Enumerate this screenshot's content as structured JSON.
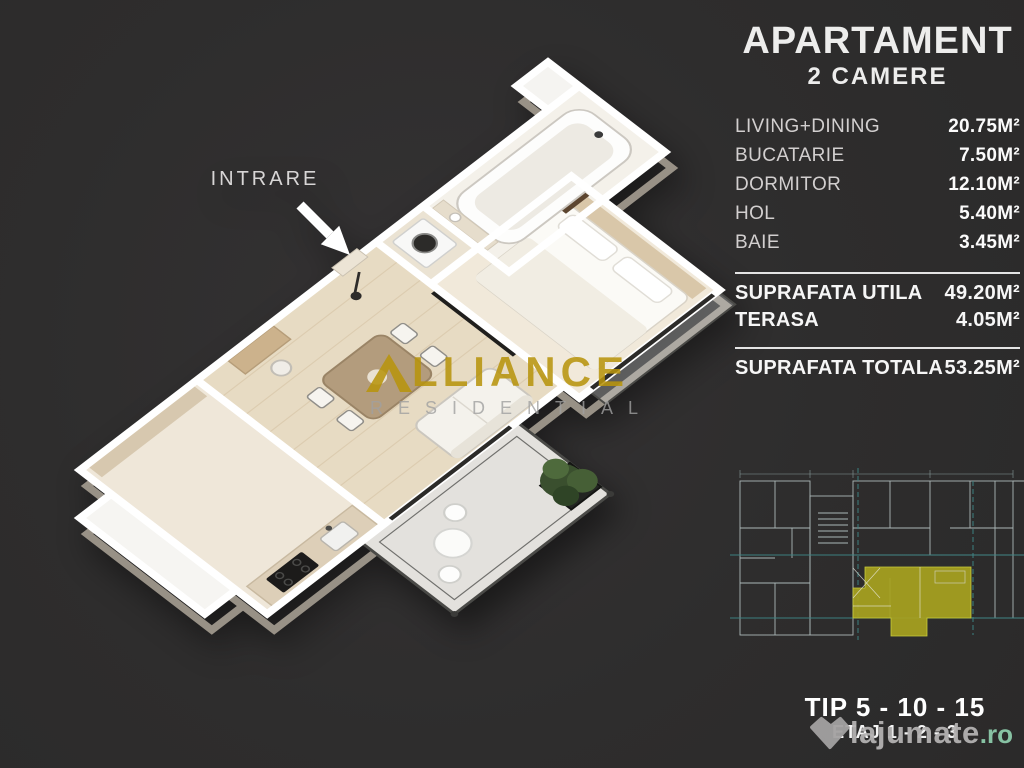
{
  "colors": {
    "background": "#2f2e2e",
    "accent_gold": "#b7940e",
    "highlight_olive": "#a8a320",
    "plan_teal": "#3d8585",
    "brand_mint": "#8ccbaa",
    "text_white": "#f2f2f2"
  },
  "entrance": {
    "label": "INTRARE"
  },
  "panel": {
    "title": "APARTAMENT",
    "subtitle": "2 CAMERE",
    "rooms": [
      {
        "name": "LIVING+DINING",
        "area": "20.75M²"
      },
      {
        "name": "BUCATARIE",
        "area": "7.50M²"
      },
      {
        "name": "DORMITOR",
        "area": "12.10M²"
      },
      {
        "name": "HOL",
        "area": "5.40M²"
      },
      {
        "name": "BAIE",
        "area": "3.45M²"
      }
    ],
    "summary": [
      {
        "name": "SUPRAFATA UTILA",
        "area": "49.20M²"
      },
      {
        "name": "TERASA",
        "area": "4.05M²"
      }
    ],
    "total": {
      "name": "SUPRAFATA TOTALA",
      "area": "53.25M²"
    }
  },
  "footer": {
    "tip": "TIP 5 - 10 - 15",
    "etaj": "ETAJ 1 - 2 - 3"
  },
  "watermarks": {
    "alliance": {
      "full": "ALLIANCE",
      "after_logo": "LLIANCE",
      "line2": "RESIDENTIAL"
    },
    "site": {
      "name": "lajumate",
      "tld": ".ro"
    }
  }
}
